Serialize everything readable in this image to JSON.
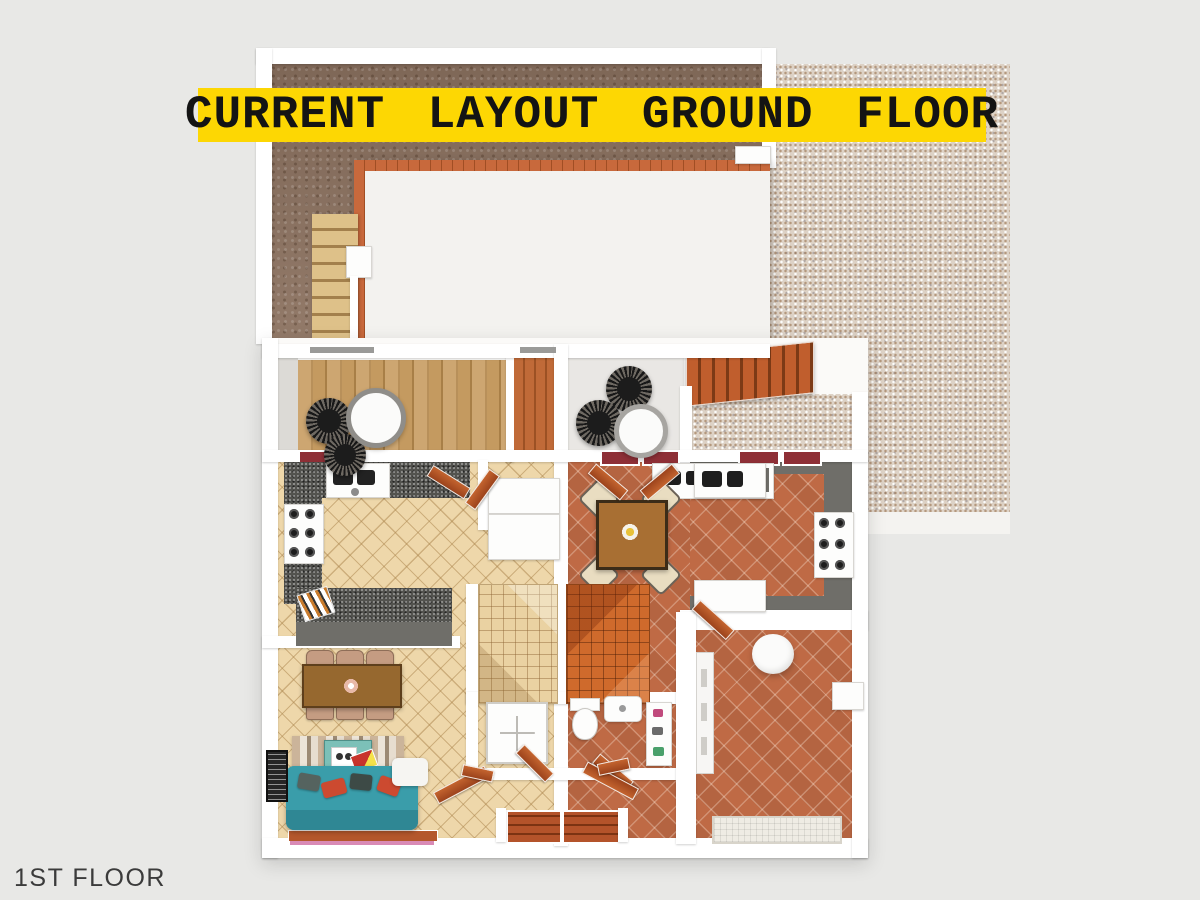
{
  "banner": {
    "text": "CURRENT LAYOUT GROUND FLOOR"
  },
  "floor_label": {
    "text": "1ST FLOOR"
  },
  "palette": {
    "background": "#e8e8e6",
    "banner_bg": "#fdd703",
    "banner_text": "#141414",
    "dirt": "#8c7260",
    "terrazzo": "#ddd2c6",
    "beige_tile": "#eed7aa",
    "terracotta_tile": "#bf6a45",
    "counter_dark": "#53534f",
    "counter_gray": "#6f6e69",
    "sofa_teal": "#3a9daa",
    "wall_white": "#ffffff"
  }
}
